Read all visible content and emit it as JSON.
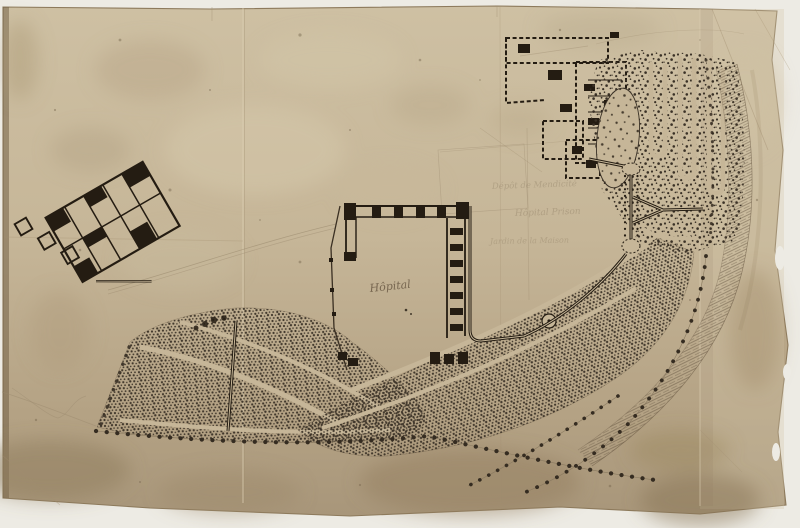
{
  "plan": {
    "description": "Scanned antique hand-drawn site plan on aged, creased paper: a hospital quadrangle, dashed outbuilding complex, serpentine pleasure gardens, stippled orchards, tree-lined avenues and a hatched embankment slope",
    "labels": {
      "hospital": "Hôpital",
      "annotation_upper": "Dépôt de Mendicité",
      "annotation_middle": "Hôpital Prison",
      "annotation_lower": "Jardin de la Maison"
    },
    "colors": {
      "scan_background": "#edebe4",
      "paper": "#c6b698",
      "paper_light": "#d6c9ac",
      "paper_dark": "#a3906f",
      "ink": "#241c12",
      "pencil": "#8d7c62"
    }
  }
}
